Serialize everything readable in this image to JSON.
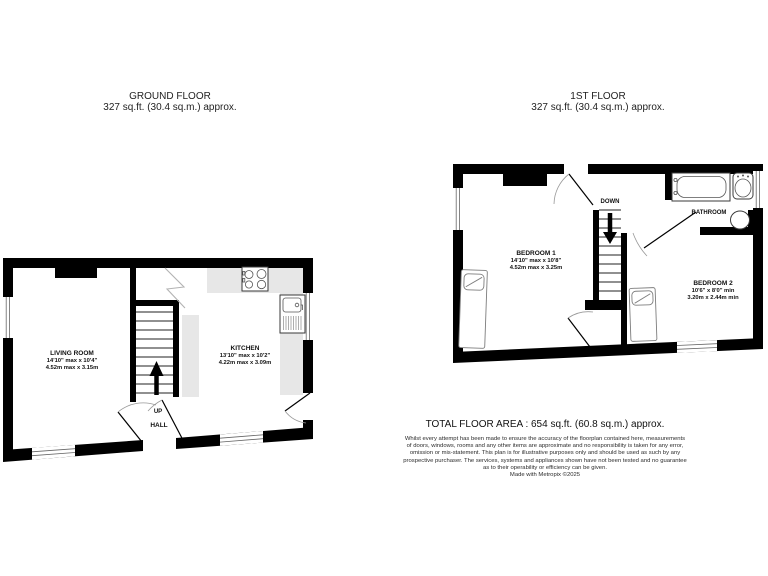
{
  "ground_floor": {
    "title": "GROUND FLOOR",
    "area": "327 sq.ft. (30.4 sq.m.) approx.",
    "rooms": {
      "living_room": {
        "name": "LIVING ROOM",
        "dims_imperial": "14'10\" max x 10'4\"",
        "dims_metric": "4.52m max x 3.15m"
      },
      "kitchen": {
        "name": "KITCHEN",
        "dims_imperial": "13'10\" max x 10'2\"",
        "dims_metric": "4.22m max x 3.09m"
      },
      "hall": {
        "name": "HALL"
      }
    },
    "labels": {
      "up": "UP"
    }
  },
  "first_floor": {
    "title": "1ST FLOOR",
    "area": "327 sq.ft. (30.4 sq.m.) approx.",
    "rooms": {
      "bedroom1": {
        "name": "BEDROOM 1",
        "dims_imperial": "14'10\" max x 10'8\"",
        "dims_metric": "4.52m max x 3.25m"
      },
      "bedroom2": {
        "name": "BEDROOM 2",
        "dims_imperial": "10'6\" x 8'0\" min",
        "dims_metric": "3.20m x 2.44m min"
      },
      "bathroom": {
        "name": "BATHROOM"
      }
    },
    "labels": {
      "down": "DOWN"
    }
  },
  "footer": {
    "total_area": "TOTAL FLOOR AREA : 654 sq.ft. (60.8 sq.m.) approx.",
    "disclaimer": [
      "Whilst every attempt has been made to ensure the accuracy of the floorplan contained here, measurements",
      "of doors, windows, rooms and any other items are approximate and no responsibility is taken for any error,",
      "omission or mis-statement. This plan is for illustrative purposes only and should be used as such by any",
      "prospective purchaser. The services, systems and appliances shown have not been tested and no guarantee",
      "as to their operability or efficiency can be given."
    ],
    "credit": "Made with Metropix ©2025"
  },
  "colors": {
    "wall": "#000000",
    "counter": "#e7e7e7",
    "fixture": "#3a3a3a"
  }
}
